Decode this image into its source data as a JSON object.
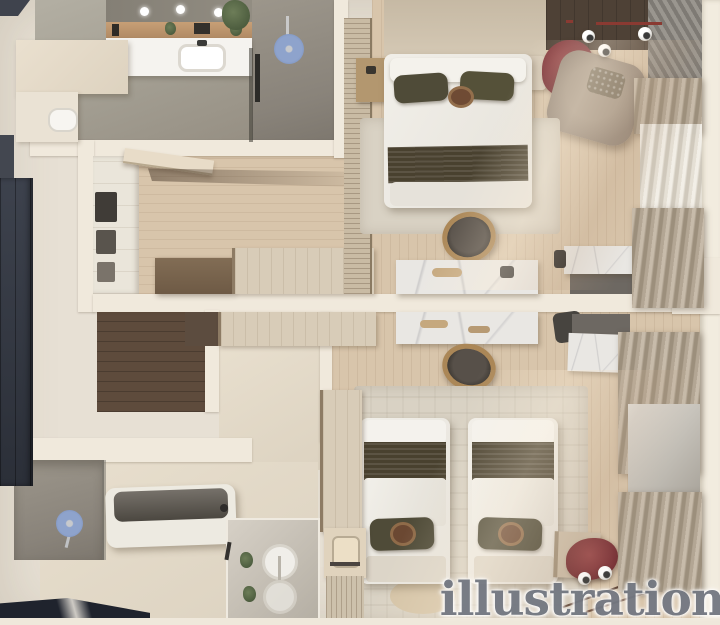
{
  "scene": {
    "type": "3d-apartment-floor-plan-render",
    "watermark": "illustration"
  },
  "palette": {
    "wall": "#e7e0d4",
    "wall_light": "#f0e9dc",
    "wood": "#d8c5ab",
    "wood_dark": "#5e4b3c",
    "concrete": "#a39e92",
    "dark_panel": "#353a45",
    "navy_corner": "#1f232d",
    "accent_blue": "#7d94c2",
    "marble": "#e9e7e3",
    "blanket": "#49412f",
    "pillow": "#4f4b38",
    "armchair_taupe": "#97897b",
    "curtain_taupe": "#b3a694",
    "curtain_sheer": "#e6e1d7",
    "plant_red": "#7a3338",
    "plant_green": "#5c6b4a",
    "rug": "#d9d2c4",
    "wicker": "#ab8757",
    "watermark": "#737882"
  }
}
